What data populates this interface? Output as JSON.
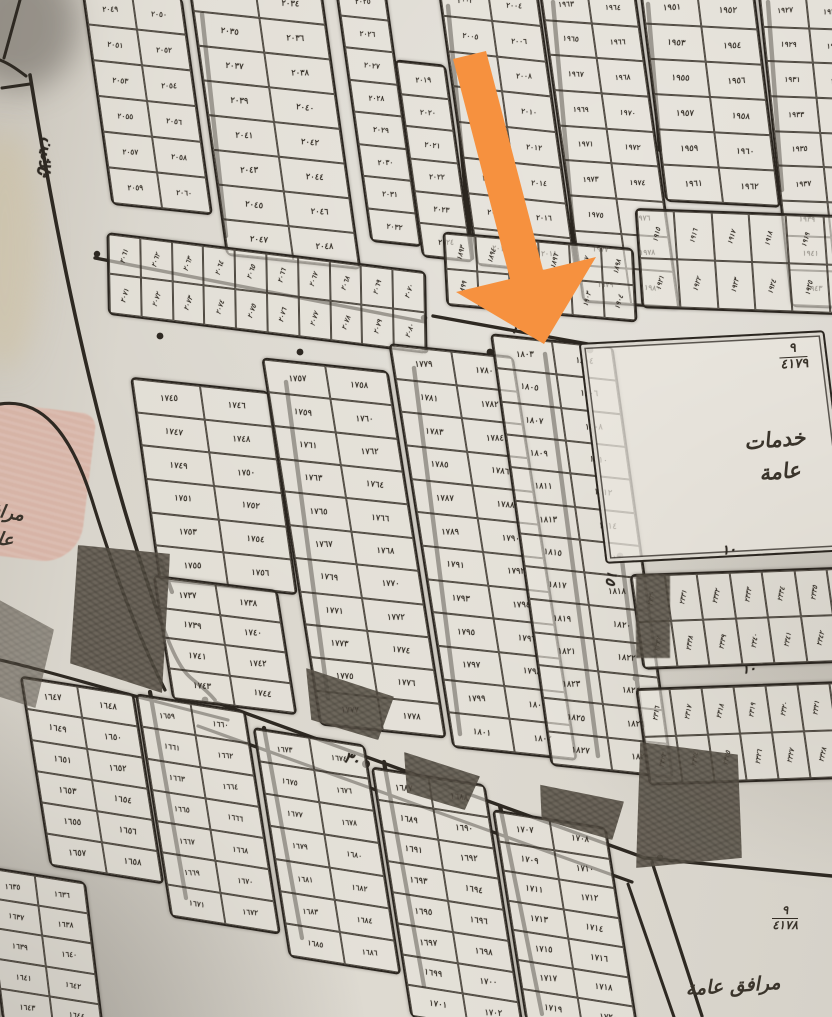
{
  "colors": {
    "paper": "#d9d5cc",
    "ink": "#2b2620",
    "shaded_block": "#5d564b",
    "pink_block": "#d8b0a2",
    "arrow_orange": "#f6913f"
  },
  "landmarks": {
    "services": {
      "line1": "خدمات",
      "line2": "عامة",
      "fraction_top": "٩",
      "fraction_bottom": "٤١٧٩"
    },
    "facilities_right": {
      "label": "مرافق عامة",
      "fraction_top": "٩",
      "fraction_bottom": "٤١٧٨"
    },
    "facilities_left": {
      "line1": "مرافق",
      "line2": "عامة"
    }
  },
  "street_labels": [
    {
      "id": "street-name",
      "text": "ثلاثين",
      "x": 36,
      "y": 138,
      "rot": 14,
      "vertical": true,
      "size": 17
    },
    {
      "id": "width-30-top",
      "text": "٣٠",
      "x": 512,
      "y": 320,
      "rot": 12,
      "vertical": false,
      "size": 15
    },
    {
      "id": "width-30-bottom",
      "text": "٣٠",
      "x": 344,
      "y": 750,
      "rot": 18,
      "vertical": false,
      "size": 15
    },
    {
      "id": "width-15",
      "text": "١٥",
      "x": 603,
      "y": 570,
      "rot": 10,
      "vertical": true,
      "size": 14
    },
    {
      "id": "width-10-upper",
      "text": "١٠",
      "x": 722,
      "y": 543,
      "rot": -5,
      "vertical": false,
      "size": 13
    },
    {
      "id": "width-10-lower",
      "text": "١٠",
      "x": 742,
      "y": 662,
      "rot": -5,
      "vertical": false,
      "size": 13
    }
  ],
  "plot_strips": [
    {
      "id": "t1",
      "x": 96,
      "y": -6,
      "w": 98,
      "h": 210,
      "rot": 6,
      "skew": 14,
      "rows": 6,
      "cols": 2,
      "start": 2049,
      "end": 2060,
      "vertNums": false
    },
    {
      "id": "t2",
      "x": 206,
      "y": -16,
      "w": 132,
      "h": 272,
      "rot": 6,
      "skew": 14,
      "rows": 8,
      "cols": 2,
      "start": 2033,
      "end": 2048,
      "vertNums": false
    },
    {
      "id": "t3",
      "x": 352,
      "y": -14,
      "w": 48,
      "h": 252,
      "rot": 6,
      "skew": 14,
      "rows": 8,
      "cols": 1,
      "start": 2025,
      "end": 2032,
      "vertNums": false
    },
    {
      "id": "t4",
      "x": 408,
      "y": 64,
      "w": 48,
      "h": 190,
      "rot": 6,
      "skew": 14,
      "rows": 6,
      "cols": 1,
      "start": 2019,
      "end": 2024,
      "vertNums": false
    },
    {
      "id": "t5",
      "x": 456,
      "y": -14,
      "w": 98,
      "h": 278,
      "rot": 6,
      "skew": 14,
      "rows": 8,
      "cols": 2,
      "start": 2003,
      "end": 2018,
      "vertNums": false
    },
    {
      "id": "t6",
      "x": 560,
      "y": -12,
      "w": 94,
      "h": 312,
      "rot": 4,
      "skew": 12,
      "rows": 9,
      "cols": 2,
      "start": 1963,
      "end": 1980,
      "vertNums": false
    },
    {
      "id": "t7",
      "x": 652,
      "y": -10,
      "w": 112,
      "h": 210,
      "rot": 3,
      "skew": 10,
      "rows": 6,
      "cols": 2,
      "start": 1951,
      "end": 1962,
      "vertNums": false
    },
    {
      "id": "t8",
      "x": 774,
      "y": -8,
      "w": 92,
      "h": 312,
      "rot": 2,
      "skew": 8,
      "rows": 9,
      "cols": 2,
      "start": 1927,
      "end": 1944,
      "vertNums": false
    },
    {
      "id": "h1",
      "x": 106,
      "y": 252,
      "w": 318,
      "h": 78,
      "rot": 7,
      "skew": 8,
      "rows": 2,
      "cols": 10,
      "start": 2061,
      "end": 2080,
      "vertNums": true
    },
    {
      "id": "h2",
      "x": 444,
      "y": 240,
      "w": 188,
      "h": 70,
      "rot": 5,
      "skew": 8,
      "rows": 2,
      "cols": 6,
      "start": 1893,
      "end": 1904,
      "vertNums": true
    },
    {
      "id": "h3",
      "x": 638,
      "y": 212,
      "w": 224,
      "h": 96,
      "rot": 2,
      "skew": 6,
      "rows": 2,
      "cols": 6,
      "start": 1915,
      "end": 1926,
      "vertNums": true
    },
    {
      "id": "m1",
      "x": 144,
      "y": 386,
      "w": 136,
      "h": 196,
      "rot": 6,
      "skew": 14,
      "rows": 6,
      "cols": 2,
      "start": 1745,
      "end": 1756,
      "vertNums": false
    },
    {
      "id": "m1b",
      "x": 162,
      "y": 584,
      "w": 122,
      "h": 118,
      "rot": 7,
      "skew": 16,
      "rows": 4,
      "cols": 2,
      "start": 1737,
      "end": 1744,
      "vertNums": false
    },
    {
      "id": "m2",
      "x": 290,
      "y": 368,
      "w": 124,
      "h": 356,
      "rot": 6,
      "skew": 15,
      "rows": 11,
      "cols": 2,
      "start": 1757,
      "end": 1778,
      "vertNums": false
    },
    {
      "id": "m3",
      "x": 420,
      "y": 354,
      "w": 122,
      "h": 392,
      "rot": 6,
      "skew": 15,
      "rows": 12,
      "cols": 2,
      "start": 1779,
      "end": 1802,
      "vertNums": false
    },
    {
      "id": "m4",
      "x": 520,
      "y": 344,
      "w": 120,
      "h": 420,
      "rot": 6,
      "skew": 14,
      "rows": 13,
      "cols": 2,
      "start": 1803,
      "end": 1828,
      "vertNums": false
    },
    {
      "id": "b1",
      "x": 34,
      "y": 688,
      "w": 112,
      "h": 180,
      "rot": 9,
      "skew": 18,
      "rows": 6,
      "cols": 2,
      "start": 1647,
      "end": 1658,
      "vertNums": false
    },
    {
      "id": "b2",
      "x": 152,
      "y": 706,
      "w": 108,
      "h": 212,
      "rot": 9,
      "skew": 18,
      "rows": 7,
      "cols": 2,
      "start": 1659,
      "end": 1672,
      "vertNums": false
    },
    {
      "id": "b3",
      "x": 270,
      "y": 740,
      "w": 110,
      "h": 218,
      "rot": 9,
      "skew": 18,
      "rows": 7,
      "cols": 2,
      "start": 1673,
      "end": 1686,
      "vertNums": false
    },
    {
      "id": "b4",
      "x": 390,
      "y": 780,
      "w": 112,
      "h": 238,
      "rot": 9,
      "skew": 18,
      "rows": 8,
      "cols": 2,
      "start": 1687,
      "end": 1702,
      "vertNums": false
    },
    {
      "id": "b5",
      "x": 508,
      "y": 822,
      "w": 112,
      "h": 200,
      "rot": 9,
      "skew": 18,
      "rows": 7,
      "cols": 2,
      "start": 1707,
      "end": 1720,
      "vertNums": false
    },
    {
      "id": "bl",
      "x": -8,
      "y": 876,
      "w": 100,
      "h": 146,
      "rot": 9,
      "skew": 16,
      "rows": 5,
      "cols": 2,
      "start": 1635,
      "end": 1644,
      "vertNums": false
    },
    {
      "id": "r1",
      "x": 636,
      "y": 570,
      "w": 228,
      "h": 92,
      "rot": -2,
      "skew": 6,
      "rows": 2,
      "cols": 7,
      "start": 2330,
      "end": 2343,
      "vertNums": true
    },
    {
      "id": "r2",
      "x": 642,
      "y": 684,
      "w": 224,
      "h": 94,
      "rot": -2,
      "skew": 6,
      "rows": 2,
      "cols": 7,
      "start": 2316,
      "end": 2329,
      "vertNums": true
    }
  ],
  "arrow": {
    "color": "#f6913f",
    "tip_label_pointed_at": "٣٠"
  }
}
